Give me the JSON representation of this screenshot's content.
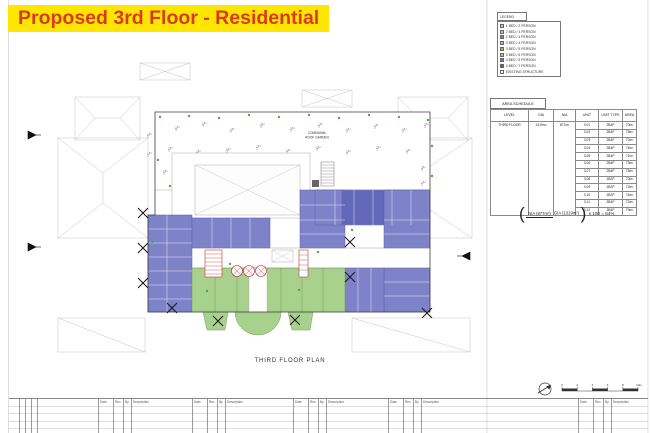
{
  "sheet": {
    "caption": "THIRD FLOOR PLAN"
  },
  "title": {
    "text": "Proposed 3rd Floor - Residential",
    "bg": "#ffe600",
    "fg": "#d93a20"
  },
  "legend": {
    "title": "LEGEND",
    "items": [
      {
        "label": "1 BED / 2 PERSON",
        "color": "#a9d18e"
      },
      {
        "label": "2 BED / 3 PERSON",
        "color": "#9dc3e6"
      },
      {
        "label": "2 BED / 4 PERSON",
        "color": "#7e82c8"
      },
      {
        "label": "3 BED / 4 PERSON",
        "color": "#d2b98a"
      },
      {
        "label": "3 BED / 5 PERSON",
        "color": "#e8923c"
      },
      {
        "label": "3 BED / 6 PERSON",
        "color": "#b9c982"
      },
      {
        "label": "4 BED / 5 PERSON",
        "color": "#8f6db4"
      },
      {
        "label": "4 BED / 7 PERSON",
        "color": "#9c4632"
      },
      {
        "label": "EXISTING STRUCTURE",
        "color": "#ffffff"
      }
    ]
  },
  "area_schedule": {
    "title": "AREA SCHEDULE",
    "columns": [
      "LEVEL",
      "GIA",
      "NIA",
      "UNIT",
      "UNIT TYPE",
      "AREA"
    ],
    "level": "THIRD FLOOR",
    "gia": "1319m²",
    "nia": "877m²",
    "rows": [
      {
        "unit": "3.01",
        "type": "2B4P",
        "area": "70m²"
      },
      {
        "unit": "3.02",
        "type": "2B4P",
        "area": "75m²"
      },
      {
        "unit": "3.03",
        "type": "2B4P",
        "area": "72m²"
      },
      {
        "unit": "3.04",
        "type": "2B4P",
        "area": "74m²"
      },
      {
        "unit": "3.05",
        "type": "2B4P",
        "area": "71m²"
      },
      {
        "unit": "3.06",
        "type": "2B4P",
        "area": "73m²"
      },
      {
        "unit": "3.07",
        "type": "2B4P",
        "area": "75m²"
      },
      {
        "unit": "3.08",
        "type": "1B2P",
        "area": "70m²"
      },
      {
        "unit": "3.09",
        "type": "1B2P",
        "area": "72m²"
      },
      {
        "unit": "3.10",
        "type": "1B2P",
        "area": "74m²"
      },
      {
        "unit": "3.11",
        "type": "2B4P",
        "area": "72m²"
      },
      {
        "unit": "3.12",
        "type": "2B4P",
        "area": "79m²"
      }
    ]
  },
  "efficiency": {
    "numerator": "NIA (877m²)",
    "denominator": "GIA (1319m²)",
    "suffix": "x 100 = 64%"
  },
  "plan": {
    "garden_label_1": "COMMUNAL",
    "garden_label_2": "ROOF GARDEN",
    "unit_colors": {
      "two_bed": "#7e82c8",
      "two_bed_dark": "#6468b8",
      "one_bed": "#a9d18e"
    }
  },
  "scale_bar": {
    "labels": [
      "0",
      "2",
      "4",
      "6",
      "8",
      "10m"
    ]
  },
  "revision_strip": {
    "headers": [
      "Date",
      "Rev",
      "By",
      "Description"
    ]
  }
}
